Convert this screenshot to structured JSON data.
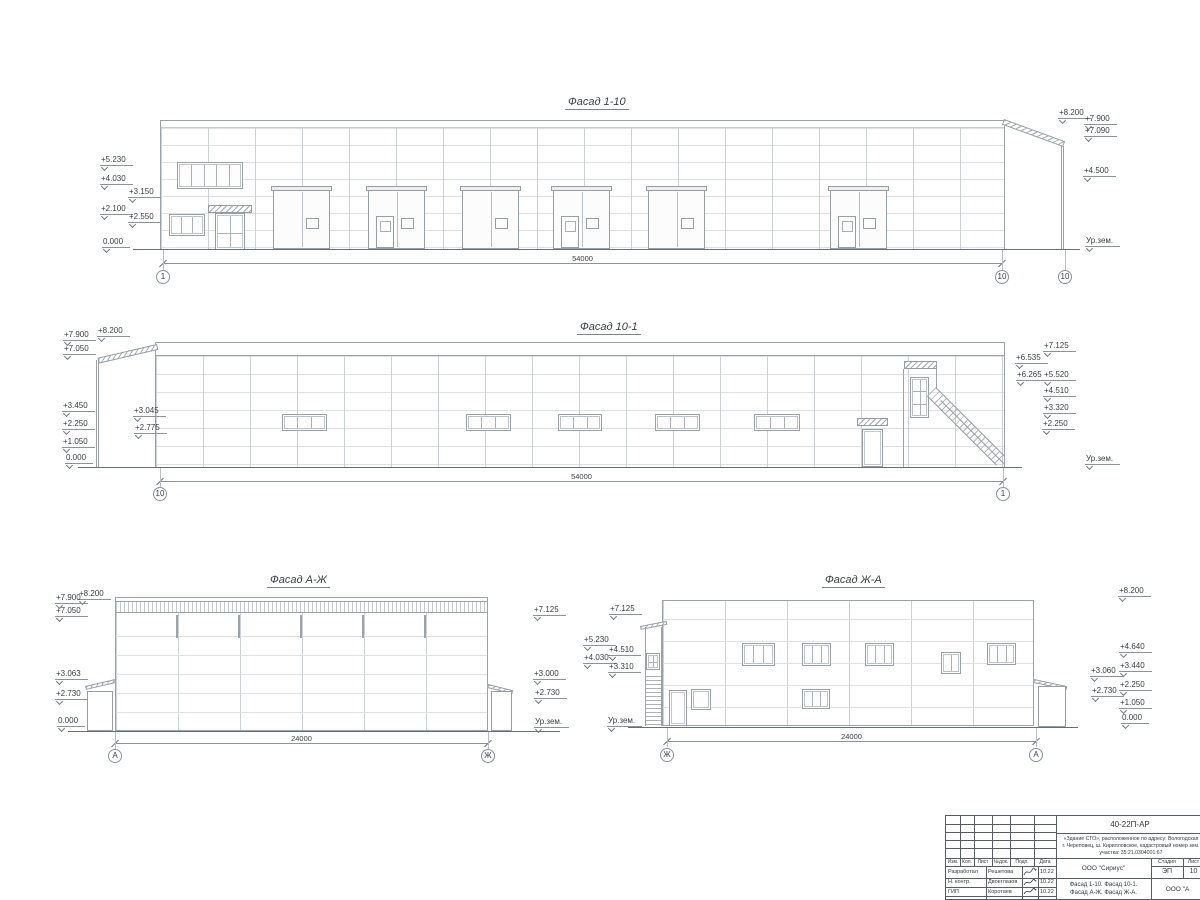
{
  "facades": {
    "f110": {
      "title": "Фасад 1-10",
      "dim": "54000",
      "axisL": "1",
      "axisR": "10",
      "axisR2": "10",
      "left": [
        "+5.230",
        "+4.030",
        "+3.150",
        "+2.100",
        "+2.550",
        "0.000"
      ],
      "right": [
        "+8.200",
        "+7.900",
        "+7.090",
        "+4.500",
        "Ур.зем."
      ]
    },
    "f101": {
      "title": "Фасад 10-1",
      "dim": "54000",
      "axisL": "10",
      "axisR": "1",
      "left": [
        "+8.200",
        "+7.900",
        "+7.050",
        "+3.450",
        "+2.250",
        "+1.050",
        "0.000"
      ],
      "inner": [
        "+3.045",
        "+2.775"
      ],
      "right": [
        "+7.125",
        "+6.535",
        "+6.265",
        "+5.520",
        "+4.510",
        "+3.320",
        "+2.250",
        "Ур.зем."
      ]
    },
    "faj": {
      "title": "Фасад А-Ж",
      "dim": "24000",
      "axisL": "А",
      "axisR": "Ж",
      "left": [
        "+8.200",
        "+7.900",
        "+7.050",
        "+3.063",
        "+2.730",
        "0.000"
      ],
      "right": [
        "+7.125",
        "+3.000",
        "+2.730",
        "Ур.зем."
      ]
    },
    "fja": {
      "title": "Фасад Ж-А",
      "dim": "24000",
      "axisL": "Ж",
      "axisR": "А",
      "left": [
        "+7.125",
        "+5.230",
        "+4.510",
        "+4.030",
        "+3.310",
        "Ур.зем."
      ],
      "inner": [
        "+3.060",
        "+2.730"
      ],
      "right": [
        "+8.200",
        "+4.640",
        "+3.440",
        "+2.250",
        "+1.050",
        "0.000"
      ]
    }
  },
  "titleblock": {
    "doc": "40-22П-АР",
    "desc1": "«Здание СТО», расположенное по адресу: Вологодская",
    "desc2": "г. Череповец, ш. Кирилловское, кадастровый номер зем.",
    "desc3": "участка: 35:21.0304001:67",
    "col_izm": "Изм.",
    "col_kol": "Кол.",
    "col_list": "Лист",
    "col_ndok": "№док.",
    "col_podp": "Подп.",
    "col_data": "Дата",
    "rows": [
      {
        "role": "Разработал",
        "name": "Решетова",
        "date": "10.22"
      },
      {
        "role": "Н. контр.",
        "name": "Двоеглазов",
        "date": "10.22"
      },
      {
        "role": "ГИП",
        "name": "Коротаев",
        "date": "10.22"
      }
    ],
    "org": "ООО \"Сириус\"",
    "stage_label": "Стадия",
    "list_label": "Лист",
    "stage": "ЭП",
    "list_num": "10",
    "subject1": "Фасад 1-10. Фасад 10-1.",
    "subject2": "Фасад А-Ж. Фасад Ж-А.",
    "org2": "ООО \"А"
  }
}
